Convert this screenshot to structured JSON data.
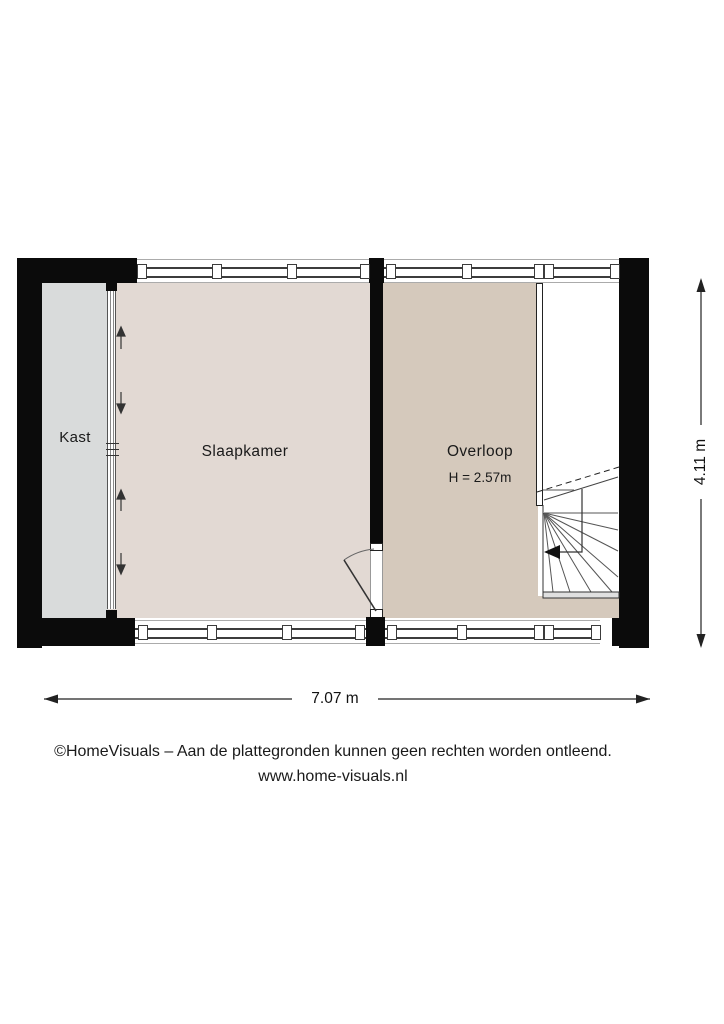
{
  "floorplan": {
    "rooms": {
      "kast": {
        "label": "Kast"
      },
      "slaapkamer": {
        "label": "Slaapkamer"
      },
      "overloop": {
        "label": "Overloop",
        "ceiling_height": "H = 2.57m"
      }
    },
    "dimensions": {
      "width": "7.07 m",
      "height": "4.11 m"
    },
    "colors": {
      "wall": "#0b0b0b",
      "kast_floor": "#d9dbdb",
      "slaapkamer_floor": "#e2d9d3",
      "overloop_floor": "#d5c9bc",
      "window_frame": "#3c3c3c",
      "stair_line": "#555555"
    }
  },
  "footer": {
    "copyright": "©HomeVisuals – Aan de plattegronden kunnen geen rechten worden ontleend.",
    "website": "www.home-visuals.nl"
  }
}
